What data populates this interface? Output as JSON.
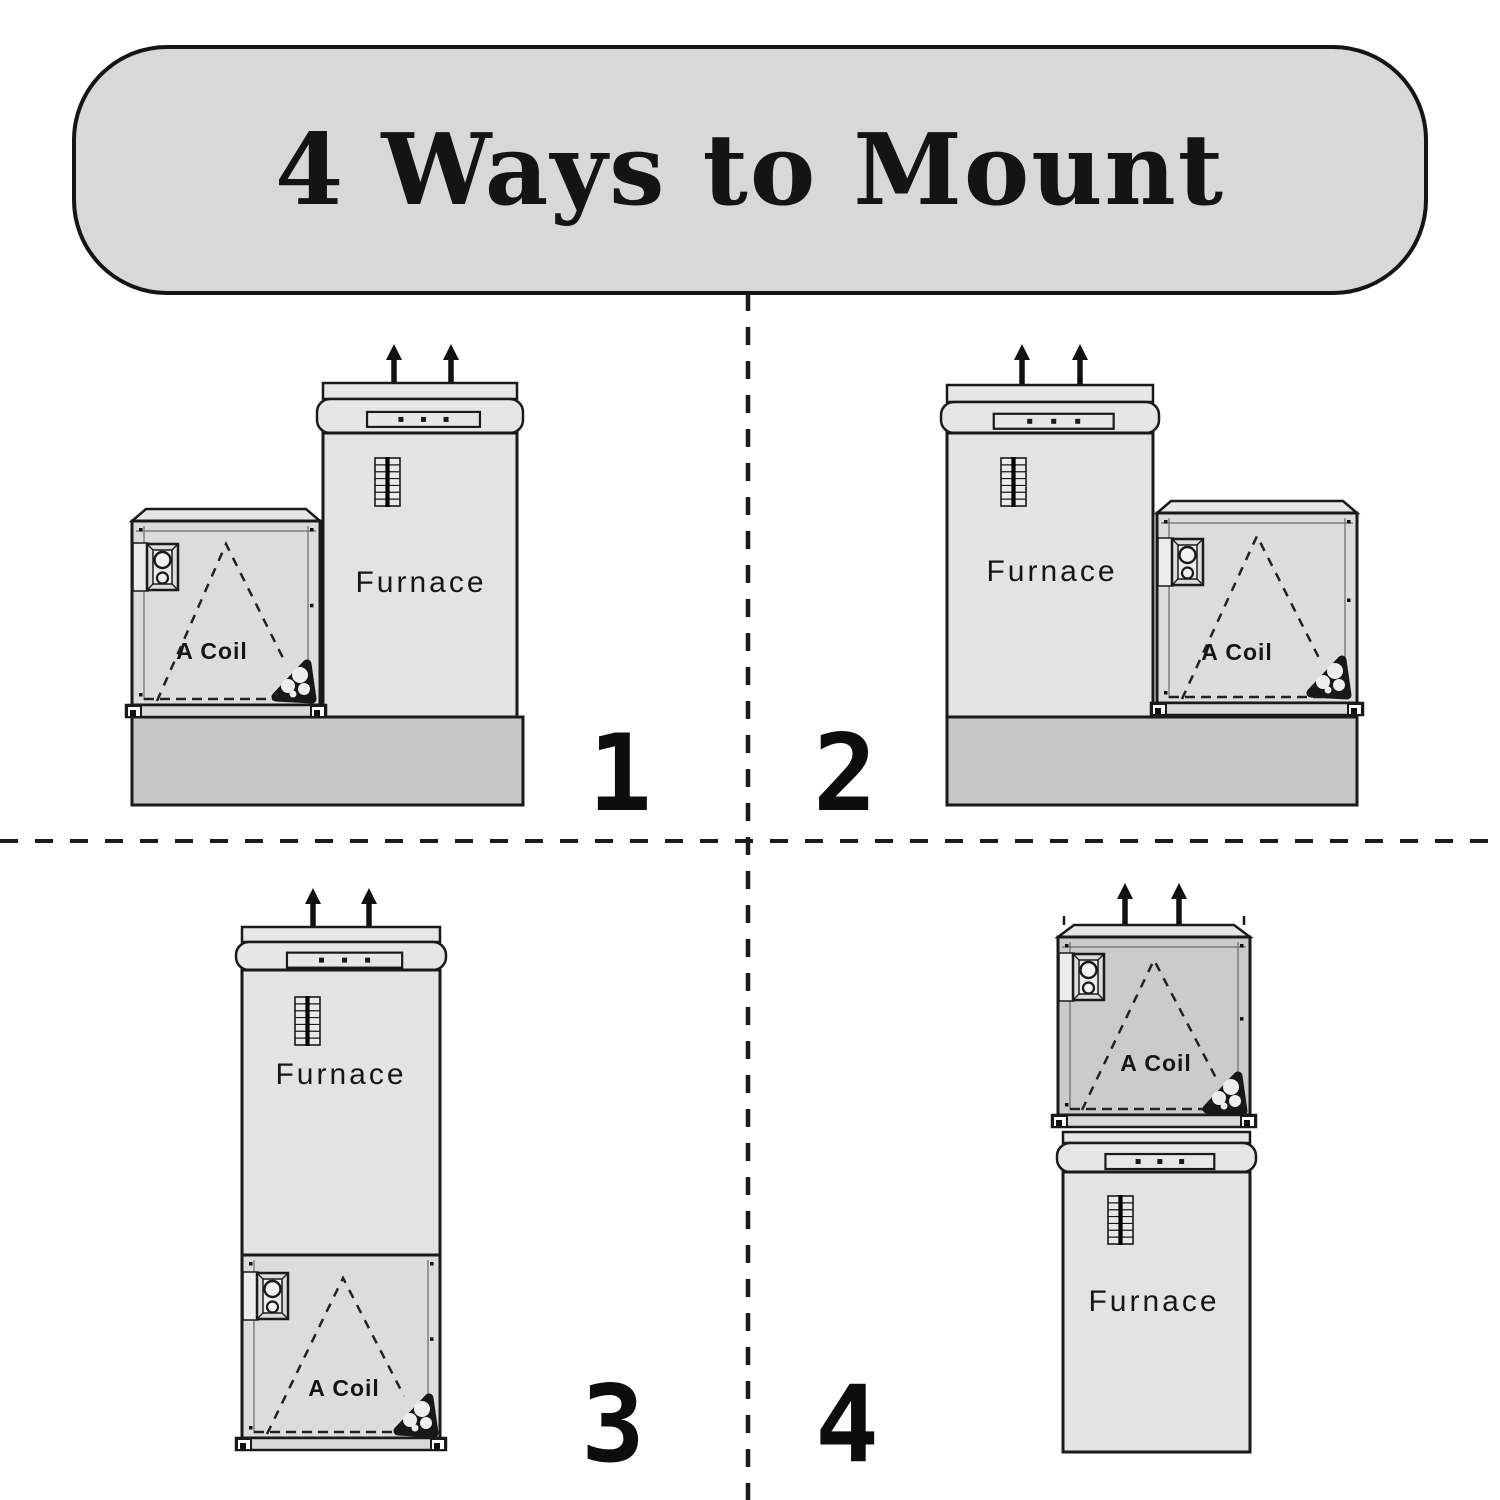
{
  "banner": {
    "title": "4 Ways to Mount"
  },
  "quadrants": [
    {
      "number": "1",
      "arrangement": "side-by-side, A-coil left of furnace, on base",
      "furnace_label": "Furnace",
      "acoil_label": "A Coil"
    },
    {
      "number": "2",
      "arrangement": "side-by-side, A-coil right of furnace, on base",
      "furnace_label": "Furnace",
      "acoil_label": "A Coil"
    },
    {
      "number": "3",
      "arrangement": "stacked, A-coil below furnace",
      "furnace_label": "Furnace",
      "acoil_label": "A Coil"
    },
    {
      "number": "4",
      "arrangement": "stacked, A-coil above furnace",
      "furnace_label": "Furnace",
      "acoil_label": "A Coil"
    }
  ],
  "colors": {
    "background": "#ffffff",
    "banner_fill": "#d8d8d8",
    "outline": "#1a1a1a",
    "furnace_fill": "#e3e3e3",
    "cap_fill": "#e6e6e6",
    "acoil_fill": "#dcdcdc",
    "acoil_fill_dark": "#cbcbcb",
    "plinth_fill": "#c7c7c7",
    "rail_fill": "#d9d9d9",
    "vent_fill": "#eaeaea",
    "flange_inner_fill": "#ececec",
    "pipe_fill": "#181818",
    "arrow_color": "#111111",
    "dash_color": "#1c1c1c",
    "text": "#141414"
  }
}
